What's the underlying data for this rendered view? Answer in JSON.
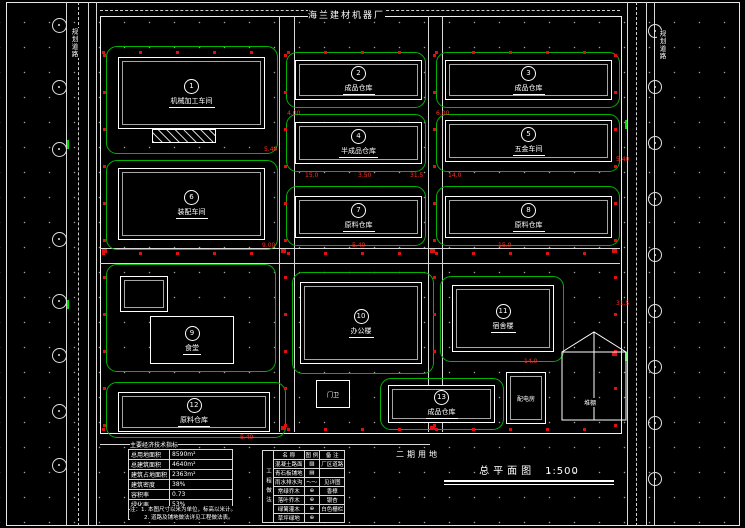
{
  "title": "海兰建材机器厂",
  "drawing": {
    "phase2_label": "二期用地",
    "title_block_name": "总平面图",
    "title_block_scale": "1:500"
  },
  "roads": {
    "left_label": "规划道路",
    "right_label": "规划道路"
  },
  "buildings": [
    {
      "num": "1",
      "label": "机械加工车间"
    },
    {
      "num": "2",
      "label": "成品仓库"
    },
    {
      "num": "3",
      "label": "成品仓库"
    },
    {
      "num": "4",
      "label": "半成品仓库"
    },
    {
      "num": "5",
      "label": "五金车间"
    },
    {
      "num": "6",
      "label": "装配车间"
    },
    {
      "num": "7",
      "label": "原料仓库"
    },
    {
      "num": "8",
      "label": "原料仓库"
    },
    {
      "num": "9",
      "label": "食堂"
    },
    {
      "num": "10",
      "label": "办公楼"
    },
    {
      "num": "11",
      "label": "宿舍楼"
    },
    {
      "num": "12",
      "label": "原料仓库"
    },
    {
      "num": "13",
      "label": "成品仓库"
    }
  ],
  "aux_buildings": [
    {
      "label": "配电房"
    },
    {
      "label": "门卫"
    },
    {
      "label": "堆棚"
    }
  ],
  "stats_table": {
    "caption": "主要经济技术指标",
    "rows": [
      {
        "label": "总用地面积",
        "value": "8590m²"
      },
      {
        "label": "总建筑面积",
        "value": "4640m²"
      },
      {
        "label": "建筑占地面积",
        "value": "2363m²"
      },
      {
        "label": "建筑密度",
        "value": "38%"
      },
      {
        "label": "容积率",
        "value": "0.73"
      },
      {
        "label": "绿化率",
        "value": "53%"
      },
      {
        "label": "建筑高度",
        "value": "13.4m,10.9m,4.3m"
      }
    ]
  },
  "notes": {
    "line1": "注：1. 本图尺寸以米为单位，标高以米计。",
    "line2": "2. 道路及铺地做法详见工程做法表。"
  },
  "legend_table": {
    "side_label": "工程做法",
    "headers": [
      "名 称",
      "图 例",
      "备 注"
    ],
    "rows": [
      {
        "name": "混凝土路面",
        "sym": "▨",
        "remark": "厂区道路"
      },
      {
        "name": "青石板铺地",
        "sym": "▤",
        "remark": ""
      },
      {
        "name": "雨水排水沟",
        "sym": "〜〜",
        "remark": "见详图"
      },
      {
        "name": "常绿乔木",
        "sym": "⊕",
        "remark": "香樟"
      },
      {
        "name": "落叶乔木",
        "sym": "⊕",
        "remark": "银杏"
      },
      {
        "name": "绿篱灌木",
        "sym": "⊕",
        "remark": "白色栅栏"
      },
      {
        "name": "草坪绿地",
        "sym": "⊕",
        "remark": ""
      }
    ]
  },
  "dims": [
    {
      "v": "5.40"
    },
    {
      "v": "15.0"
    },
    {
      "v": "3.50"
    },
    {
      "v": "31.5"
    },
    {
      "v": "14.0"
    },
    {
      "v": "9.00"
    },
    {
      "v": "5.40"
    },
    {
      "v": "15.0"
    },
    {
      "v": "4.00"
    },
    {
      "v": "6.00"
    },
    {
      "v": "5.40"
    },
    {
      "v": "31.5"
    },
    {
      "v": "5.40"
    },
    {
      "v": "14.0"
    }
  ],
  "colors": {
    "background": "#000000",
    "line": "#ffffff",
    "green": "#00b400",
    "red": "#e01010"
  }
}
